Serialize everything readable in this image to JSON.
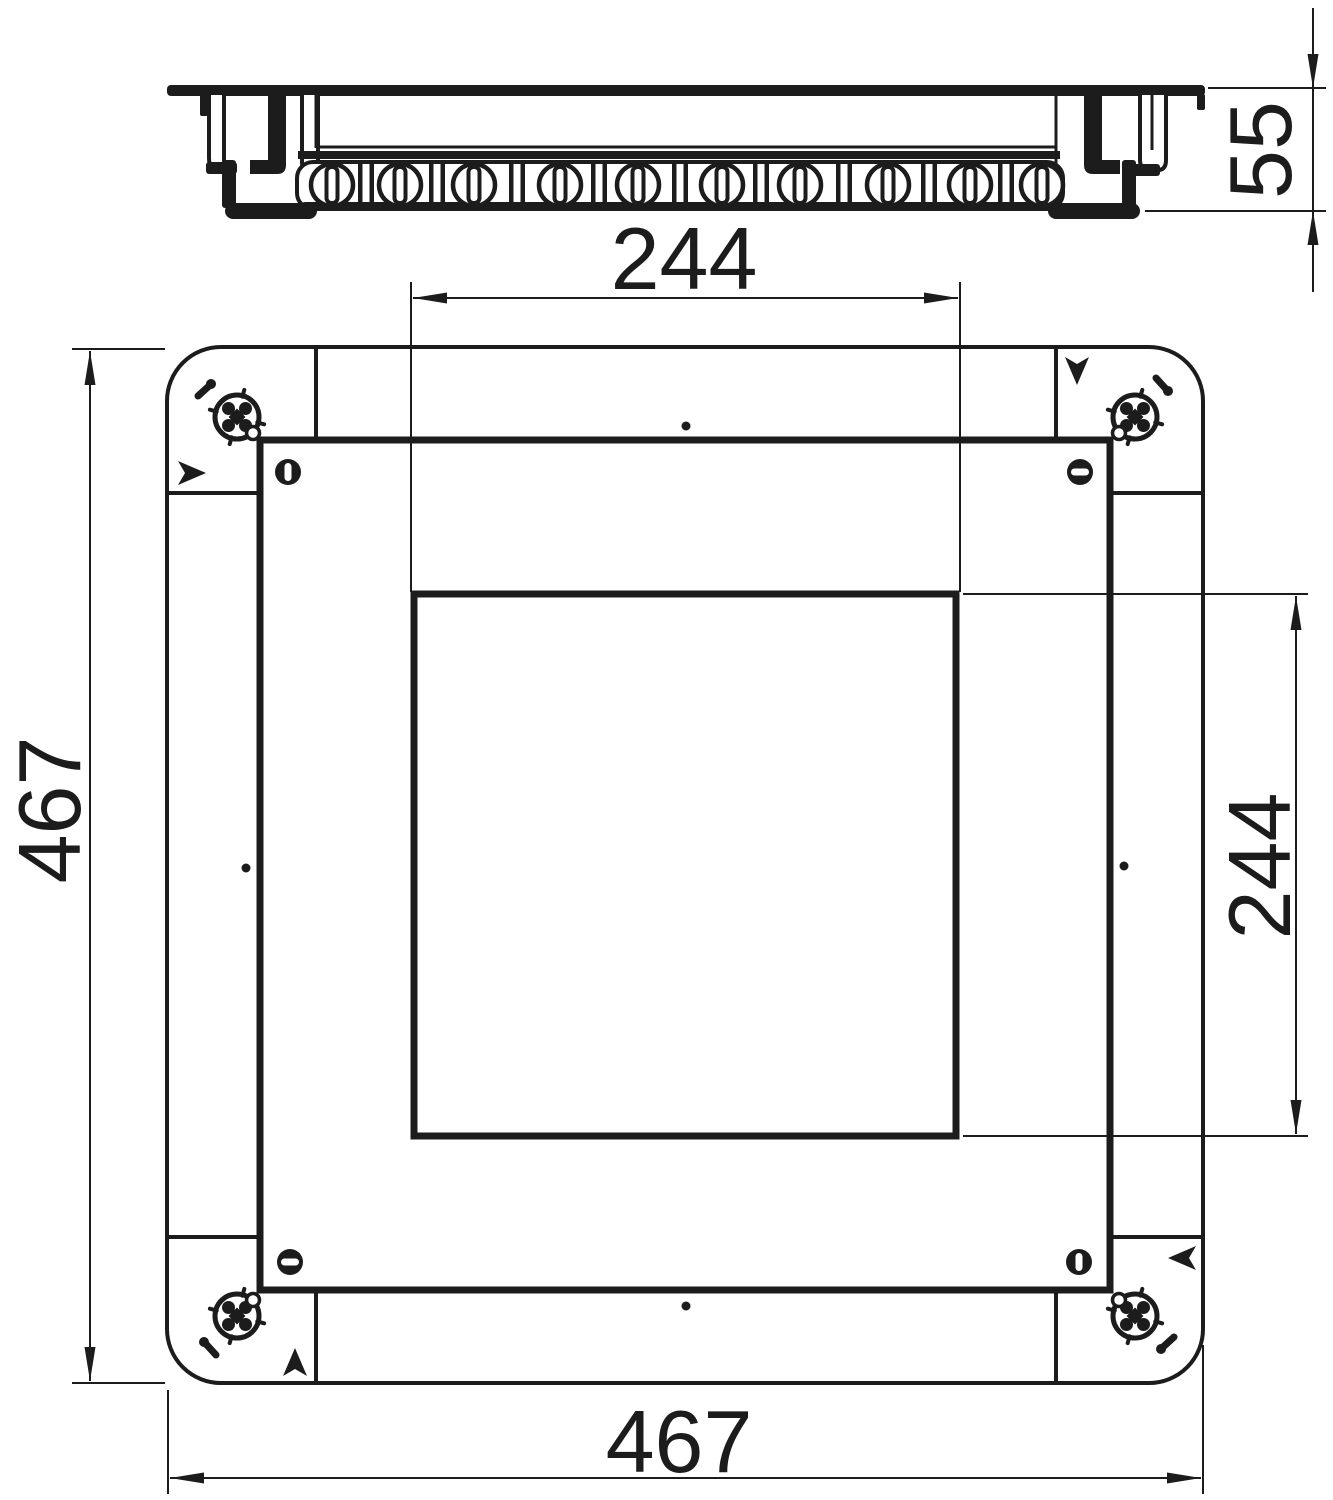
{
  "drawing": {
    "kind": "technical dimension drawing",
    "subject": "square floor-box / junction box with cover frame",
    "ink_color": "#1c1c1c",
    "background_color": "#ffffff"
  },
  "views": {
    "side_view": {
      "name": "side elevation",
      "knockout_count": 10,
      "knockout_style": "circular knockouts with vertical slots separated by double ribs"
    },
    "plan_view": {
      "name": "plan view",
      "corner_screw_count": 4,
      "slotted_screw_count": 4,
      "orientation_arrow_count": 4,
      "center_mark_count": 4
    }
  },
  "dimensions": {
    "device_height": {
      "value": "55"
    },
    "opening_width": {
      "value": "244"
    },
    "opening_height": {
      "value": "244"
    },
    "overall_width": {
      "value": "467"
    },
    "overall_height": {
      "value": "467"
    }
  }
}
